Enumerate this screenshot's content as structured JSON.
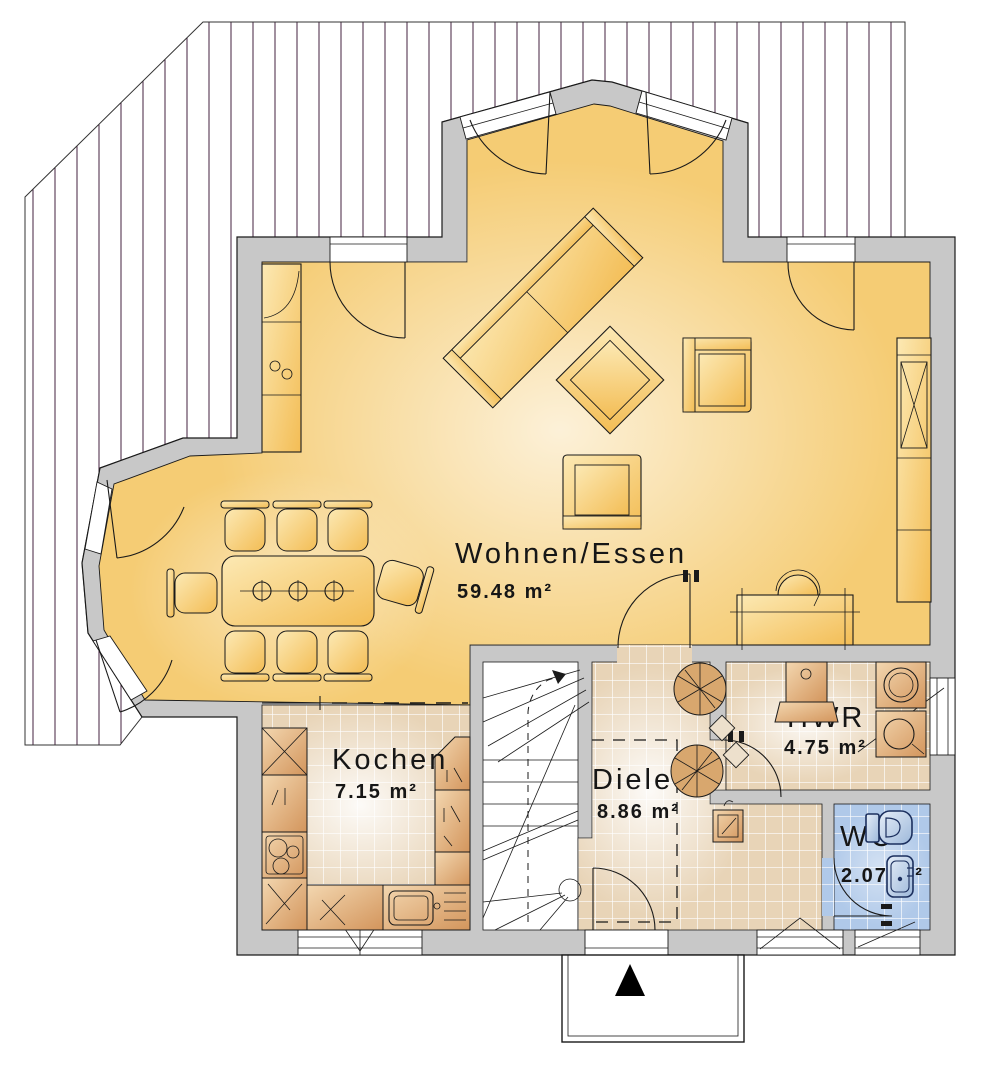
{
  "plan": {
    "type": "floorplan-ground-floor",
    "rooms": [
      {
        "id": "wohnen-essen",
        "name": "Wohnen/Essen",
        "area": "59.48 m²"
      },
      {
        "id": "kochen",
        "name": "Kochen",
        "area": "7.15 m²"
      },
      {
        "id": "diele",
        "name": "Diele",
        "area": "8.86 m²"
      },
      {
        "id": "hwr",
        "name": "HWR",
        "area": "4.75 m²"
      },
      {
        "id": "wc",
        "name": "WC",
        "area": "2.07 m²"
      }
    ],
    "symbols": {
      "north_arrow": "entrance-arrow",
      "terrace": "hatched-deck-area",
      "stairs": "winder-staircase"
    },
    "colors": {
      "wall": "#c8c8c8",
      "floor-living": "#f5cc74",
      "tile-beige": "#e8d4b7",
      "tile-blue": "#b0c9e9",
      "furniture-light": "#f6c65f",
      "furniture-wood": "#d79b5f",
      "hatch-line": "#43203f"
    }
  }
}
